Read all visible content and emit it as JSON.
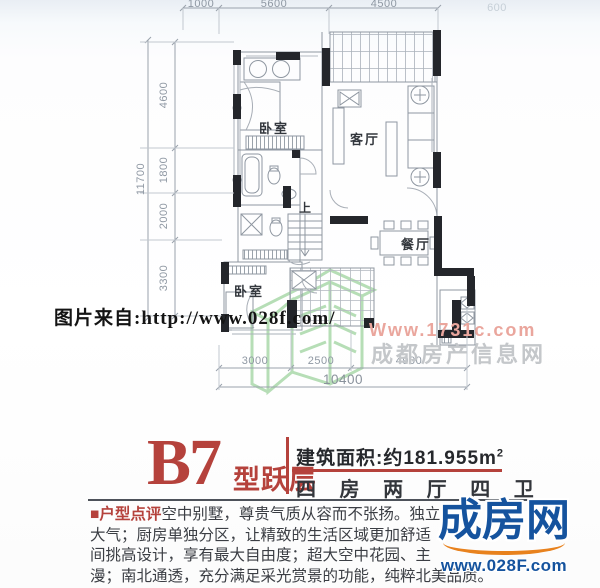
{
  "plan": {
    "rooms": {
      "bedroom_top": "卧室",
      "living": "客厅",
      "dining": "餐厅",
      "bedroom_bottom": "卧室",
      "stairs_up": "上"
    },
    "dims": {
      "top": [
        "1000",
        "5600",
        "4500"
      ],
      "top_right": "600",
      "left_total": "11700",
      "left": [
        "4600",
        "1800",
        "2000",
        "3300"
      ],
      "bottom": [
        "3000",
        "2500",
        "4900"
      ],
      "bottom_total": "10400"
    }
  },
  "watermark": {
    "caption": "图片来自:http://www.028f.com/",
    "site_url": "Www.1731c.com",
    "site_name": "成都房产信息网"
  },
  "info": {
    "unit_code": "B7",
    "unit_suffix": "型跃层",
    "area_label": "建筑面积:约181.955m",
    "area_sup": "2",
    "rooms_line": "四 房 两 厅 四 卫"
  },
  "review": {
    "tag": "■户型点评",
    "line1": "空中别墅，尊贵气质从容而不张扬。独立",
    "line2": "大气；厨房单独分区，让精致的生活区域更加舒适",
    "line3": "间挑高设计，享有最大自由度；超大空中花园、主",
    "line4": "漫；南北通透，充分满足采光赏景的功能，纯粹北美品质。"
  },
  "brand": {
    "name": "成房网",
    "url": "www.028F.com"
  },
  "colors": {
    "accent_red": "#b5423c",
    "brand_blue": "#15539e",
    "brand_orange": "#e8821e",
    "watermark_pink": "#eaa69d",
    "watermark_gray": "#c4c7ca",
    "logo_green": "#a5d6a5",
    "wall_black": "#24262b"
  }
}
